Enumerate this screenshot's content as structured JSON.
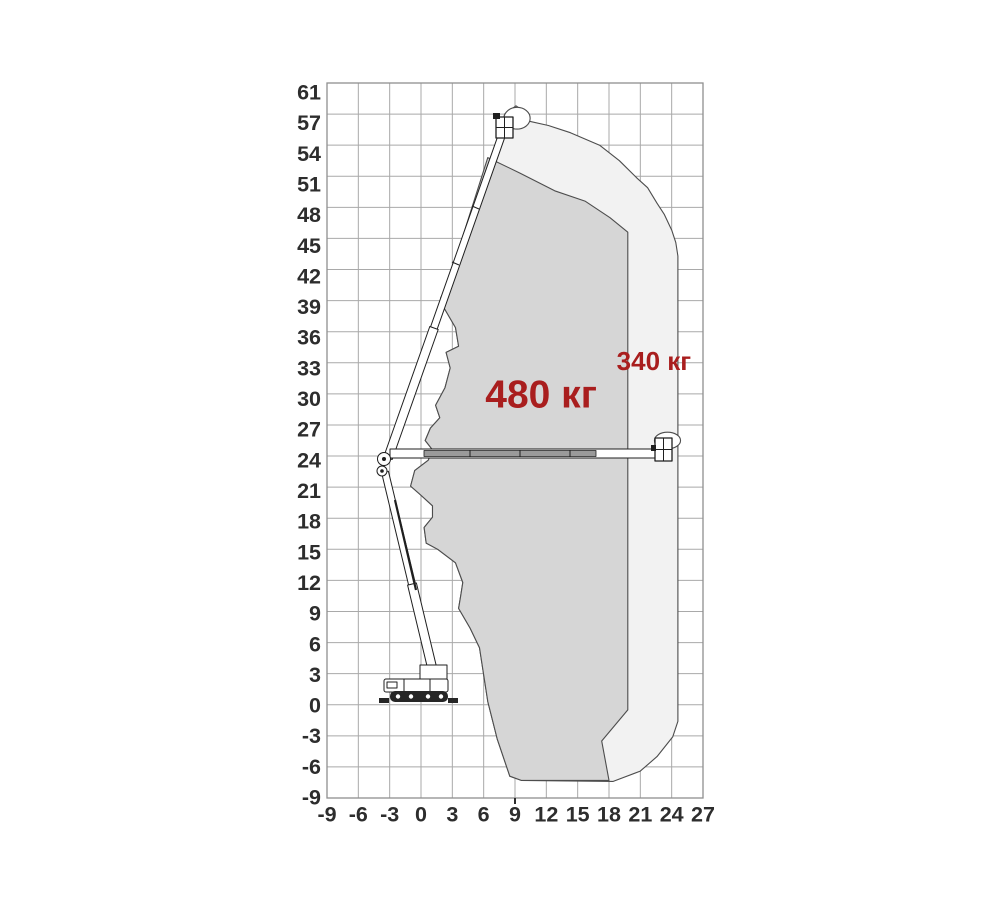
{
  "page": {
    "description": "Working envelope diagram of a telescopic boom lift with two rated-load zones",
    "background": "#ffffff"
  },
  "colors": {
    "axis_text": "#2d2d2d",
    "grid_line": "#a9a9a9",
    "plot_border": "#8f8f8f",
    "envelope_stroke": "#4d4d4d",
    "outer_fill": "#f2f2f2",
    "inner_fill": "#d6d6d6",
    "capacity_text": "#a91e1e",
    "machine_line": "#1f1f1f"
  },
  "figure": {
    "machine": "telescopic-boom-lift-side-view",
    "positions_shown": [
      "boom fully raised to top platform position",
      "boom horizontal to maximum side reach position"
    ]
  },
  "chart_data": {
    "type": "area",
    "title": "",
    "xlabel": "",
    "ylabel": "",
    "units": "m",
    "xlim": [
      -9,
      27
    ],
    "ylim": [
      -9,
      61
    ],
    "grid": true,
    "x_marker_tick": 9,
    "x_ticks": {
      "labels": [
        "-9",
        "-6",
        "-3",
        "0",
        "3",
        "6",
        "9",
        "12",
        "15",
        "18",
        "21",
        "24",
        "27"
      ],
      "positions": [
        -9,
        -6,
        -3,
        0,
        3,
        6,
        9,
        12,
        15,
        18,
        21,
        24,
        27
      ]
    },
    "y_ticks": {
      "labels": [
        "61",
        "57",
        "54",
        "51",
        "48",
        "45",
        "42",
        "39",
        "36",
        "33",
        "30",
        "27",
        "24",
        "21",
        "18",
        "15",
        "12",
        "9",
        "6",
        "3",
        "0",
        "-3",
        "-6",
        "-9"
      ],
      "positions": [
        60,
        57,
        54,
        51,
        48,
        45,
        42,
        39,
        36,
        33,
        30,
        27,
        24,
        21,
        18,
        15,
        12,
        9,
        6,
        3,
        0,
        -3,
        -6,
        -9
      ]
    },
    "platform_bumps": [
      {
        "cx": 9.2,
        "cy": 56.6,
        "rx": 1.25,
        "ry": 1.05
      },
      {
        "cx": 23.6,
        "cy": 25.5,
        "rx": 1.25,
        "ry": 0.8
      }
    ],
    "series": [
      {
        "name": "outer-envelope",
        "label": "340 кг",
        "label_pos": [
          22.3,
          33.2
        ],
        "fill_key": "outer_fill",
        "points": [
          [
            8.5,
            -6.9
          ],
          [
            7.3,
            -3.3
          ],
          [
            6.4,
            0.3
          ],
          [
            5.6,
            5.5
          ],
          [
            4.7,
            7.4
          ],
          [
            3.6,
            9.3
          ],
          [
            3.8,
            10.5
          ],
          [
            4.0,
            11.8
          ],
          [
            3.3,
            13.7
          ],
          [
            1.6,
            15.0
          ],
          [
            0.5,
            15.6
          ],
          [
            0.3,
            17.1
          ],
          [
            1.1,
            18.1
          ],
          [
            1.1,
            19.2
          ],
          [
            -0.1,
            20.3
          ],
          [
            -1.0,
            21.1
          ],
          [
            -0.6,
            22.6
          ],
          [
            0.7,
            23.6
          ],
          [
            1.1,
            24.6
          ],
          [
            0.4,
            25.5
          ],
          [
            0.9,
            26.7
          ],
          [
            1.8,
            27.7
          ],
          [
            1.4,
            28.9
          ],
          [
            2.3,
            30.6
          ],
          [
            2.8,
            32.5
          ],
          [
            2.4,
            34.0
          ],
          [
            3.6,
            34.6
          ],
          [
            3.3,
            36.4
          ],
          [
            2.2,
            38.3
          ],
          [
            1.9,
            39.3
          ],
          [
            2.5,
            40.3
          ],
          [
            3.0,
            41.2
          ],
          [
            3.3,
            43.0
          ],
          [
            7.7,
            55.3
          ],
          [
            8.0,
            57.0
          ],
          [
            9.1,
            57.8
          ],
          [
            10.2,
            57.0
          ],
          [
            10.4,
            56.3
          ],
          [
            12.2,
            55.9
          ],
          [
            14.3,
            55.2
          ],
          [
            17.1,
            54.0
          ],
          [
            19.0,
            52.5
          ],
          [
            20.7,
            50.8
          ],
          [
            21.7,
            49.9
          ],
          [
            22.6,
            48.4
          ],
          [
            23.3,
            47.3
          ],
          [
            24.0,
            45.8
          ],
          [
            24.4,
            44.6
          ],
          [
            24.6,
            43.3
          ],
          [
            24.6,
            -1.6
          ],
          [
            24.1,
            -3.1
          ],
          [
            22.6,
            -5.0
          ],
          [
            21.0,
            -6.4
          ],
          [
            18.4,
            -7.4
          ],
          [
            9.6,
            -7.3
          ]
        ]
      },
      {
        "name": "inner-envelope",
        "label": "480 кг",
        "label_pos": [
          11.5,
          30.0
        ],
        "fill_key": "inner_fill",
        "points": [
          [
            6.4,
            52.8
          ],
          [
            9.5,
            51.3
          ],
          [
            12.8,
            49.6
          ],
          [
            15.7,
            48.6
          ],
          [
            18.1,
            47.0
          ],
          [
            19.8,
            45.6
          ],
          [
            19.8,
            -0.5
          ],
          [
            17.3,
            -3.5
          ],
          [
            18.0,
            -7.3
          ],
          [
            9.6,
            -7.3
          ],
          [
            8.5,
            -6.9
          ],
          [
            7.3,
            -3.3
          ],
          [
            6.4,
            0.3
          ],
          [
            5.6,
            5.5
          ],
          [
            4.7,
            7.4
          ],
          [
            3.6,
            9.3
          ],
          [
            3.8,
            10.5
          ],
          [
            4.0,
            11.8
          ],
          [
            3.3,
            13.7
          ],
          [
            1.6,
            15.0
          ],
          [
            0.5,
            15.6
          ],
          [
            0.3,
            17.1
          ],
          [
            1.1,
            18.1
          ],
          [
            1.1,
            19.2
          ],
          [
            -0.1,
            20.3
          ],
          [
            -1.0,
            21.1
          ],
          [
            -0.6,
            22.6
          ],
          [
            0.7,
            23.6
          ],
          [
            1.1,
            24.6
          ],
          [
            0.4,
            25.5
          ],
          [
            0.9,
            26.7
          ],
          [
            1.8,
            27.7
          ],
          [
            1.4,
            28.9
          ],
          [
            2.3,
            30.6
          ],
          [
            2.8,
            32.5
          ],
          [
            2.4,
            34.0
          ],
          [
            3.6,
            34.6
          ],
          [
            3.3,
            36.4
          ],
          [
            2.2,
            38.3
          ],
          [
            1.9,
            39.3
          ],
          [
            2.5,
            40.3
          ],
          [
            3.0,
            41.2
          ],
          [
            3.3,
            43.0
          ]
        ]
      }
    ]
  }
}
